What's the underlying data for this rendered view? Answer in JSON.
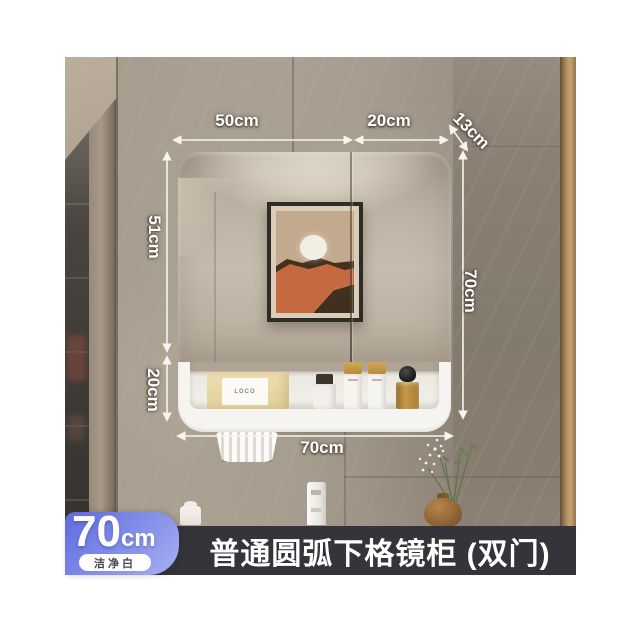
{
  "product": {
    "banner_title": "普通圆弧下格镜柜 (双门)",
    "badge": {
      "size_value": "70",
      "size_unit": "cm",
      "finish_label": "洁净白"
    }
  },
  "dimensions": {
    "mirror_left_door_width": "50cm",
    "mirror_right_door_width": "20cm",
    "cabinet_depth": "13cm",
    "mirror_height": "51cm",
    "open_shelf_height": "20cm",
    "overall_height": "70cm",
    "overall_width": "70cm"
  },
  "scene": {
    "artwork": "abstract-desert-sun-print",
    "shelf_items": [
      "tissue-box",
      "cosmetic-jar-with-brushes",
      "pump-bottle",
      "pump-bottle",
      "amber-perfume-bottle"
    ],
    "tissue_box_label": "LOCO",
    "decor": [
      "glass-display-cabinet",
      "hanging-pleated-cup",
      "toiletry-jar",
      "faucet",
      "amber-vase-with-flowers",
      "wood-trim"
    ]
  },
  "colors": {
    "banner_bg": "#35343a",
    "badge_gradient_start": "#5f6ade",
    "badge_gradient_end": "#a7b0f2",
    "dimension_line": "#f7f4ee",
    "wall_light": "#aba192",
    "wall_dark": "#857a6e",
    "cabinet_white": "#f5f4f1"
  }
}
